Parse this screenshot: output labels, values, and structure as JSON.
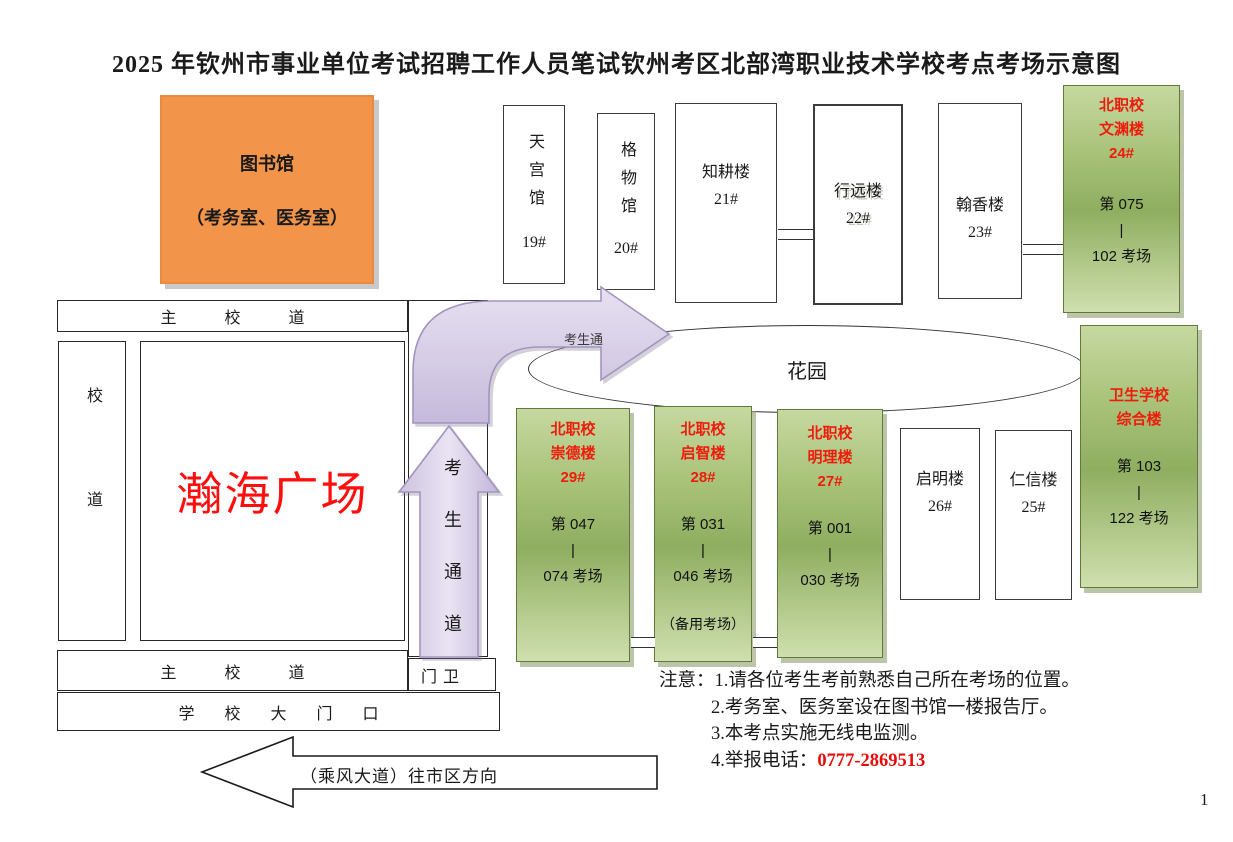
{
  "title": {
    "part1": "2025 年钦州市事业单位考试招聘工作人员笔试",
    "part2": "钦州考区北部湾职业技术学校考点考场示意图"
  },
  "library": {
    "name": "图书馆",
    "subtitle": "（考务室、医务室）"
  },
  "top_buildings": [
    {
      "name": "天宫馆",
      "num": "19#"
    },
    {
      "name": "格物馆",
      "num": "20#"
    },
    {
      "name": "知耕楼",
      "num": "21#"
    },
    {
      "name": "行远楼",
      "num": "22#"
    },
    {
      "name": "翰香楼",
      "num": "23#"
    }
  ],
  "green_buildings": {
    "wenyuan": {
      "l1": "北职校",
      "l2": "文渊楼",
      "l3": "24#",
      "r1": "第 075",
      "bar": "|",
      "r2": "102 考场"
    },
    "chongde": {
      "l1": "北职校",
      "l2": "崇德楼",
      "l3": "29#",
      "r1": "第 047",
      "bar": "|",
      "r2": "074 考场"
    },
    "qizhi": {
      "l1": "北职校",
      "l2": "启智楼",
      "l3": "28#",
      "r1": "第 031",
      "bar": "|",
      "r2": "046 考场",
      "extra": "（备用考场）"
    },
    "mingli": {
      "l1": "北职校",
      "l2": "明理楼",
      "l3": "27#",
      "r1": "第 001",
      "bar": "|",
      "r2": "030 考场"
    },
    "weisheng": {
      "l1": "卫生学校",
      "l2": "综合楼",
      "r1": "第 103",
      "bar": "|",
      "r2": "122 考场"
    }
  },
  "white_buildings": {
    "qiming": {
      "name": "启明楼",
      "num": "26#"
    },
    "renxin": {
      "name": "仁信楼",
      "num": "25#"
    }
  },
  "garden": {
    "label": "花园"
  },
  "roads": {
    "main_top": "主校道",
    "campus": "校道",
    "plaza": "瀚海广场",
    "main_bottom": "主校道",
    "gate_guard": "门卫",
    "school_gate": "学校大门口",
    "avenue": "（乘风大道）往市区方向"
  },
  "passage": {
    "vertical_label": "考生通道",
    "bent_label": "考生通"
  },
  "notes": {
    "label": "注意：",
    "item1": "1.请各位考生考前熟悉自己所在考场的位置。",
    "item2": "2.考务室、医务室设在图书馆一楼报告厅。",
    "item3": "3.本考点实施无线电监测。",
    "item4": "4.举报电话：",
    "phone": "0777-2869513"
  },
  "page_number": "1",
  "colors": {
    "accent_red": "#ee1c0c",
    "library_orange": "#f2954b",
    "building_green": "#a9c378",
    "passage_purple": "#cfc5e0"
  }
}
